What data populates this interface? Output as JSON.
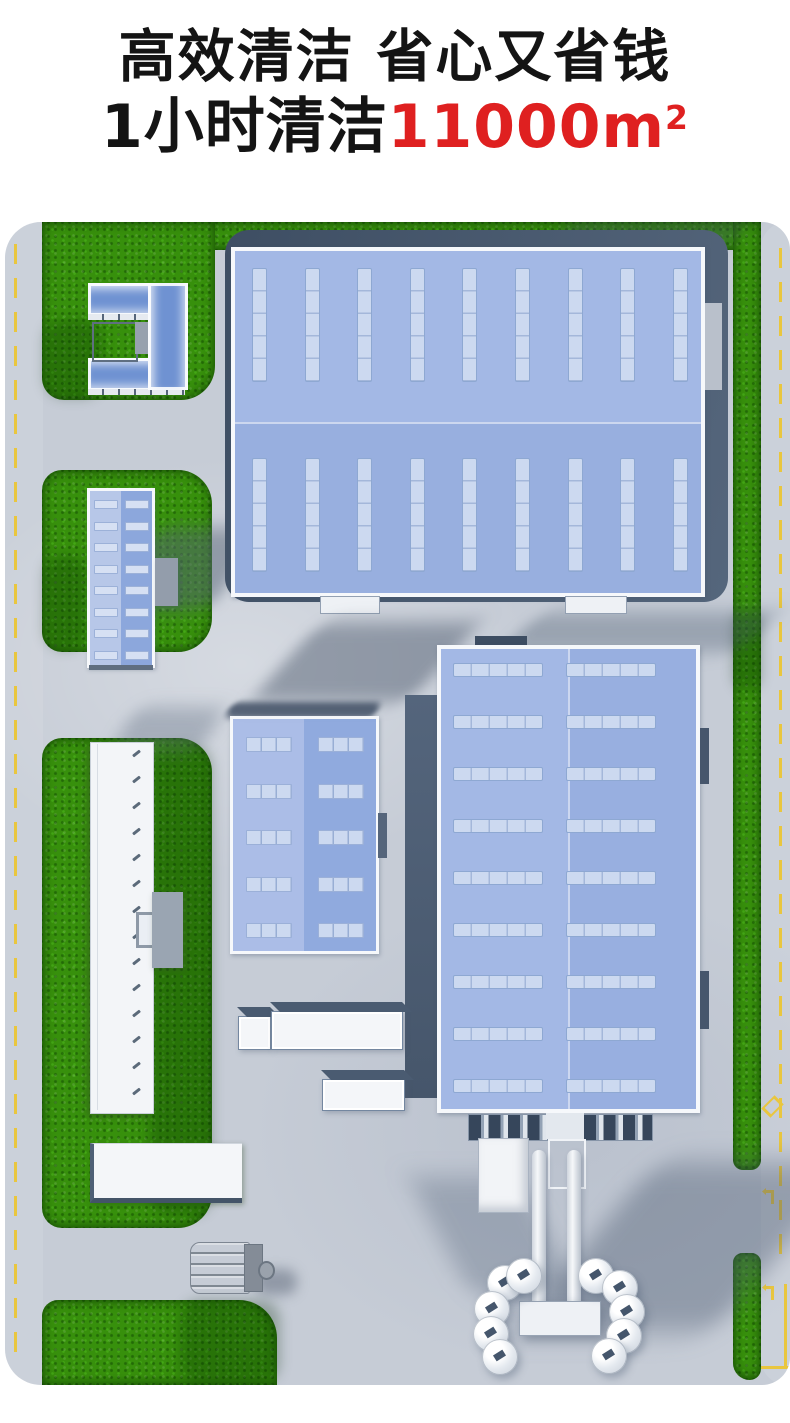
{
  "header": {
    "line1": "高效清洁 省心又省钱",
    "line2_black": "1小时清洁",
    "line2_red": "11000m",
    "line2_sup": "2",
    "text_color": "#141414",
    "highlight_color": "#df2020",
    "underline_color": "#ffd600"
  },
  "scene": {
    "type": "3d-aerial-render-industrial-park",
    "colors": {
      "pavement": "#c6ccd6",
      "grass": "#37900c",
      "warehouse_roof_blue": "#98afdf",
      "skylight_blue": "#ccd9f0",
      "building_wall_dark": "#46566c",
      "white_building": "#f4f6f9",
      "road_marking_yellow": "#e9c63e"
    },
    "objects": [
      "left-road-with-dashed-line",
      "right-road-with-markings",
      "grass-patches",
      "office-courtyard-cluster",
      "blue-roof-building-small",
      "large-warehouse-top",
      "long-white-building",
      "mid-blue-warehouse",
      "large-warehouse-bottom",
      "loading-docks",
      "silo-tank-cluster-with-pipes",
      "container-trucks",
      "white-flat-building",
      "sweeper-machine"
    ]
  }
}
